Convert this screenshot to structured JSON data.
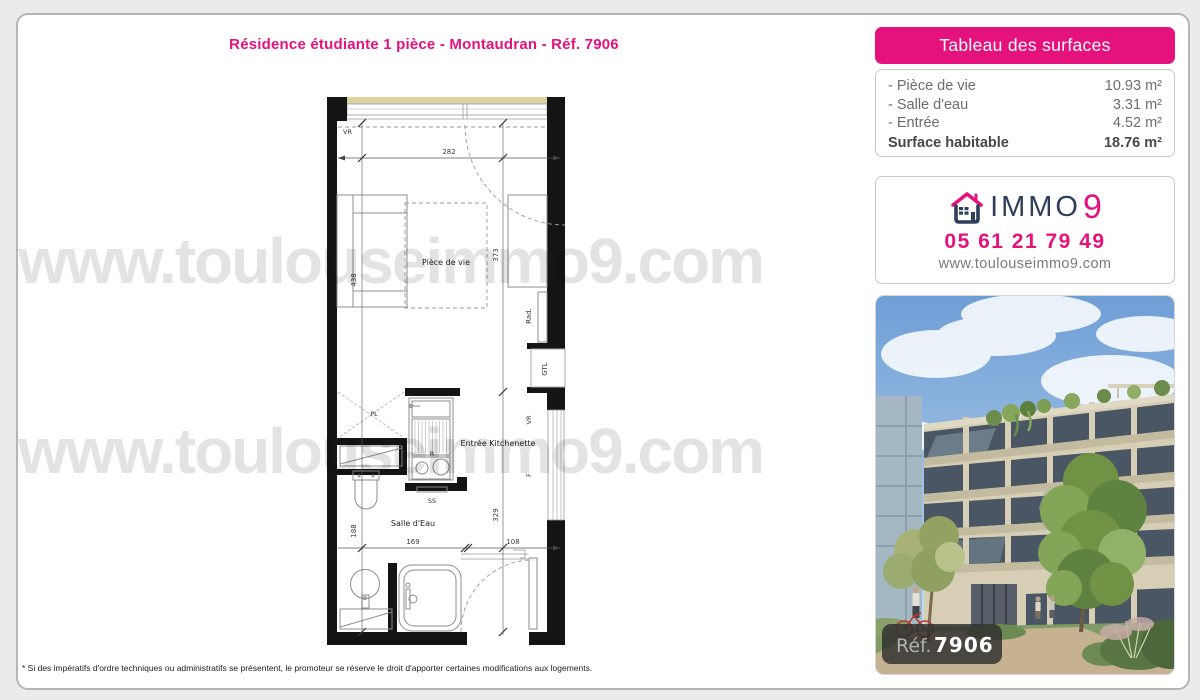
{
  "page": {
    "title": "Résidence étudiante 1 pièce - Montaudran - Réf. 7906",
    "watermark": "www.toulouseimmo9.com",
    "disclaimer": "* Si des impératifs d'ordre techniques ou administratifs se présentent, le promoteur se réserve le droit d'apporter certaines modifications aux logements."
  },
  "surfaces": {
    "header": "Tableau des surfaces",
    "rows": [
      {
        "label": "- Pièce de vie",
        "value": "10.93 m²"
      },
      {
        "label": "- Salle d'eau",
        "value": "3.31 m²"
      },
      {
        "label": "- Entrée",
        "value": "4.52 m²"
      }
    ],
    "total_label": "Surface habitable",
    "total_value": "18.76 m²"
  },
  "agency": {
    "brand_immo": "IMMO",
    "brand_nine": "9",
    "phone": "05 61 21 79 49",
    "website": "www.toulouseimmo9.com"
  },
  "photo": {
    "ref_label": "Réf.",
    "ref_number": "7906"
  },
  "plan": {
    "labels": {
      "vr_top": "VR",
      "piece_de_vie": "Pièce de vie",
      "rad": "Rad.",
      "gtl": "GTL",
      "pl": "PL",
      "r": "R",
      "ss": "SS",
      "entree_kitchenette": "Entrée Kitchenette",
      "salle_deau": "Salle d'Eau",
      "vr_right": "VR",
      "f_right": "F"
    },
    "dimensions": {
      "top_width": "282",
      "left_height_living": "438",
      "left_height_bath": "188",
      "right_height_living": "373",
      "right_height_entry": "329",
      "bottom_left": "169",
      "bottom_right": "108"
    }
  },
  "colors": {
    "accent_pink": "#e5127d",
    "brand_navy": "#2e3f5c"
  }
}
